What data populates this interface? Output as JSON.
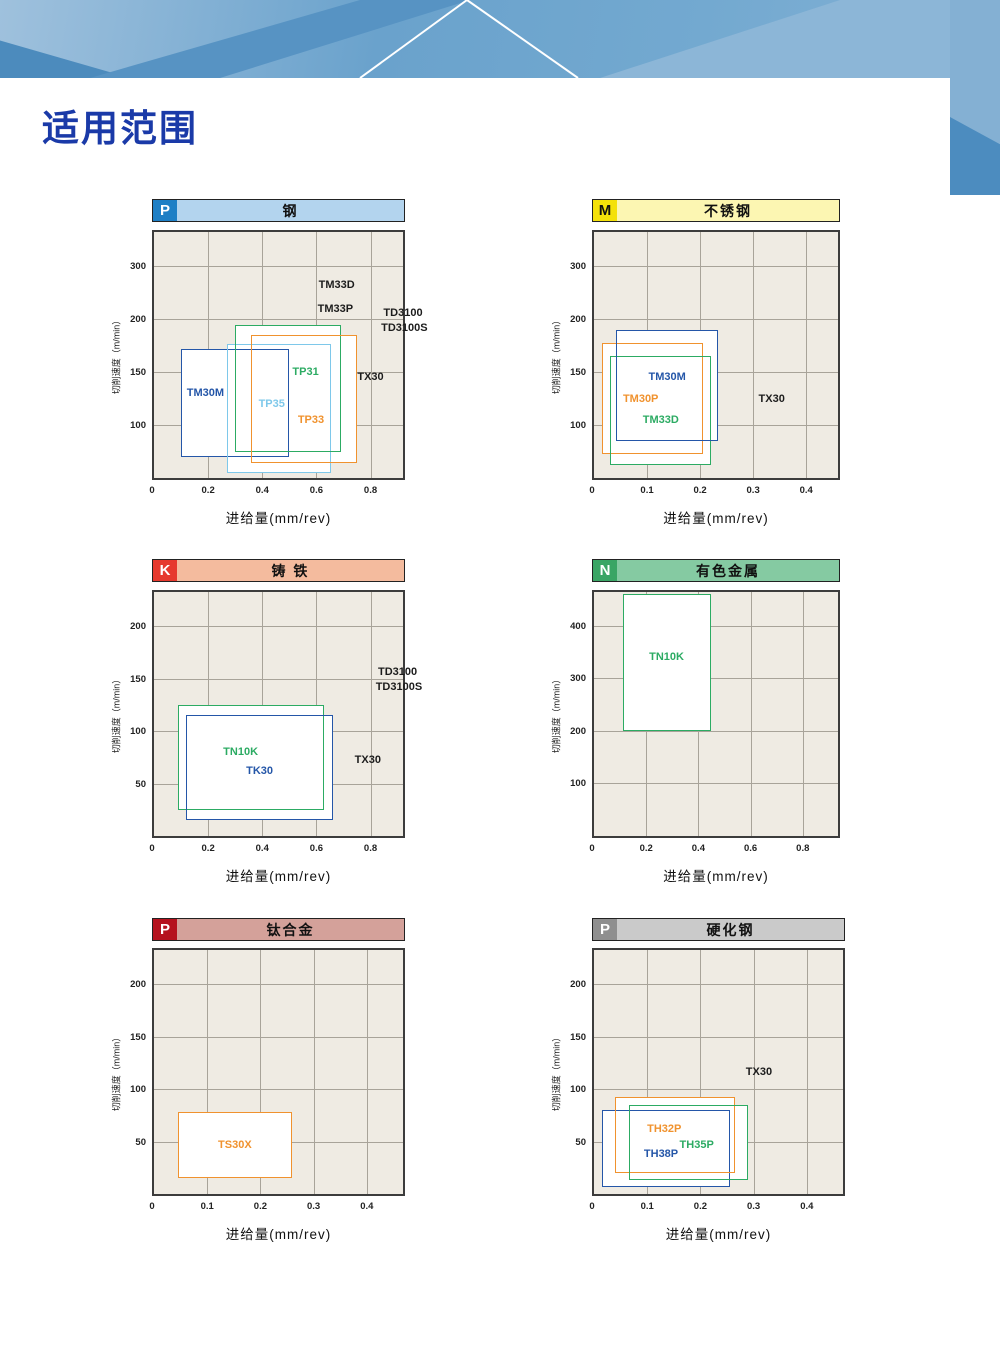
{
  "page": {
    "title": "适用范围",
    "accent": "#1a3aa8",
    "banner_colors": {
      "base": "#6aa2cc",
      "dark": "#5793c3",
      "light": "#8cb6d7",
      "line": "#ffffff"
    }
  },
  "chart_data": {
    "type": "range_boxes",
    "note": "Application range charts: cutting speed vs feed; boxes give usable range per grade",
    "charts": [
      {
        "id": "steel",
        "iso_class": "P",
        "title": "钢",
        "badge_bg": "#1e7fc5",
        "badge_fg": "#ffffff",
        "bar_bg": "#b3d4ee",
        "bar_fg": "#111111",
        "layout": {
          "x": 152,
          "header_y": 199,
          "plot_y": 230,
          "w": 253,
          "h": 250
        },
        "xlabel": "进给量(mm/rev)",
        "ylabel": "切削速度（m/min）",
        "origin_label": "0",
        "x_ticks": [
          0.2,
          0.4,
          0.6,
          0.8
        ],
        "x_max": 0.92,
        "y_ticks": [
          100,
          150,
          200,
          300
        ],
        "y_top_pad": 0.65,
        "series": [
          {
            "name": "TM30M",
            "color": "#2456a8",
            "x": [
              0.1,
              0.5
            ],
            "y": [
              40,
              172
            ]
          },
          {
            "name": "TP35",
            "color": "#7ec8ea",
            "x": [
              0.27,
              0.655
            ],
            "y": [
              10,
              177
            ]
          },
          {
            "name": "TP31",
            "color": "#2cab63",
            "x": [
              0.3,
              0.69
            ],
            "y": [
              50,
              195
            ]
          },
          {
            "name": "TP33",
            "color": "#f0922e",
            "x": [
              0.36,
              0.75
            ],
            "y": [
              28,
              185
            ]
          }
        ],
        "labels": [
          {
            "text": "TM30M",
            "x": 0.19,
            "y": 130,
            "color": "#2456a8"
          },
          {
            "text": "TP35",
            "x": 0.435,
            "y": 120,
            "color": "#7ec8ea"
          },
          {
            "text": "TP31",
            "x": 0.56,
            "y": 150,
            "color": "#2cab63"
          },
          {
            "text": "TP33",
            "x": 0.58,
            "y": 105,
            "color": "#f0922e"
          },
          {
            "text": "TX30",
            "x": 0.8,
            "y": 145,
            "color": "#1c1c1c"
          },
          {
            "text": "TM33D",
            "x": 0.675,
            "y": 265,
            "color": "#1c1c1c"
          },
          {
            "text": "TM33P",
            "x": 0.67,
            "y": 220,
            "color": "#1c1c1c"
          },
          {
            "text": "TD3100",
            "x": 0.92,
            "y": 212,
            "color": "#1c1c1c"
          },
          {
            "text": "TD3100S",
            "x": 0.925,
            "y": 192,
            "color": "#1c1c1c"
          }
        ]
      },
      {
        "id": "stainless-steel",
        "iso_class": "M",
        "title": "不锈钢",
        "badge_bg": "#f4e10a",
        "badge_fg": "#111111",
        "bar_bg": "#fcf6b2",
        "bar_fg": "#111111",
        "layout": {
          "x": 592,
          "header_y": 199,
          "plot_y": 230,
          "w": 248,
          "h": 250
        },
        "xlabel": "进给量(mm/rev)",
        "ylabel": "切削速度（m/min）",
        "origin_label": "0",
        "x_ticks": [
          0.1,
          0.2,
          0.3,
          0.4
        ],
        "x_max": 0.46,
        "y_ticks": [
          100,
          150,
          200,
          300
        ],
        "y_top_pad": 0.65,
        "series": [
          {
            "name": "TM30P",
            "color": "#f0922e",
            "x": [
              0.015,
              0.205
            ],
            "y": [
              45,
              178
            ]
          },
          {
            "name": "TM33D",
            "color": "#2cab63",
            "x": [
              0.03,
              0.22
            ],
            "y": [
              25,
              165
            ]
          },
          {
            "name": "TM30M",
            "color": "#2456a8",
            "x": [
              0.042,
              0.233
            ],
            "y": [
              70,
              190
            ]
          }
        ],
        "labels": [
          {
            "text": "TM30M",
            "x": 0.138,
            "y": 145,
            "color": "#2456a8"
          },
          {
            "text": "TM30P",
            "x": 0.088,
            "y": 125,
            "color": "#f0922e"
          },
          {
            "text": "TM33D",
            "x": 0.126,
            "y": 105,
            "color": "#2cab63"
          },
          {
            "text": "TX30",
            "x": 0.335,
            "y": 125,
            "color": "#1c1c1c"
          }
        ]
      },
      {
        "id": "cast-iron",
        "iso_class": "K",
        "title": "铸 铁",
        "badge_bg": "#e6392e",
        "badge_fg": "#ffffff",
        "bar_bg": "#f4bb9e",
        "bar_fg": "#111111",
        "layout": {
          "x": 152,
          "header_y": 559,
          "plot_y": 590,
          "w": 253,
          "h": 248
        },
        "xlabel": "进给量(mm/rev)",
        "ylabel": "切削速度（m/min）",
        "origin_label": "0",
        "x_ticks": [
          0.2,
          0.4,
          0.6,
          0.8
        ],
        "x_max": 0.92,
        "y_ticks": [
          50,
          100,
          150,
          200
        ],
        "y_top_pad": 0.65,
        "series": [
          {
            "name": "TN10K",
            "color": "#2cab63",
            "x": [
              0.09,
              0.63
            ],
            "y": [
              25,
              125
            ]
          },
          {
            "name": "TK30",
            "color": "#2456a8",
            "x": [
              0.12,
              0.66
            ],
            "y": [
              15,
              115
            ]
          }
        ],
        "labels": [
          {
            "text": "TN10K",
            "x": 0.32,
            "y": 80,
            "color": "#2cab63"
          },
          {
            "text": "TK30",
            "x": 0.39,
            "y": 62,
            "color": "#2456a8"
          },
          {
            "text": "TX30",
            "x": 0.79,
            "y": 72,
            "color": "#1c1c1c"
          },
          {
            "text": "TD3100",
            "x": 0.9,
            "y": 156,
            "color": "#1c1c1c"
          },
          {
            "text": "TD3100S",
            "x": 0.905,
            "y": 142,
            "color": "#1c1c1c"
          }
        ]
      },
      {
        "id": "non-ferrous-metal",
        "iso_class": "N",
        "title": "有色金属",
        "badge_bg": "#3aa565",
        "badge_fg": "#ffffff",
        "bar_bg": "#85caa2",
        "bar_fg": "#111111",
        "layout": {
          "x": 592,
          "header_y": 559,
          "plot_y": 590,
          "w": 248,
          "h": 248
        },
        "xlabel": "进给量(mm/rev)",
        "ylabel": "切削速度（m/min）",
        "origin_label": "0",
        "x_ticks": [
          0.2,
          0.4,
          0.6,
          0.8
        ],
        "x_max": 0.935,
        "y_ticks": [
          100,
          200,
          300,
          400
        ],
        "y_top_pad": 0.64,
        "series": [
          {
            "name": "TN10K",
            "color": "#2cab63",
            "x": [
              0.11,
              0.45
            ],
            "y": [
              200,
              460
            ]
          }
        ],
        "labels": [
          {
            "text": "TN10K",
            "x": 0.278,
            "y": 340,
            "color": "#2cab63"
          }
        ]
      },
      {
        "id": "titanium-alloy",
        "iso_class": "P",
        "title": "钛合金",
        "badge_bg": "#b5121e",
        "badge_fg": "#ffffff",
        "bar_bg": "#d4a19a",
        "bar_fg": "#111111",
        "layout": {
          "x": 152,
          "header_y": 918,
          "plot_y": 948,
          "w": 253,
          "h": 248
        },
        "xlabel": "进给量(mm/rev)",
        "ylabel": "切削速度（m/min）",
        "origin_label": "0",
        "x_ticks": [
          0.1,
          0.2,
          0.3,
          0.4
        ],
        "x_max": 0.468,
        "y_ticks": [
          50,
          100,
          150,
          200
        ],
        "y_top_pad": 0.65,
        "series": [
          {
            "name": "TS30X",
            "color": "#f0922e",
            "x": [
              0.045,
              0.26
            ],
            "y": [
              15,
              78
            ]
          }
        ],
        "labels": [
          {
            "text": "TS30X",
            "x": 0.152,
            "y": 47,
            "color": "#f0922e"
          }
        ]
      },
      {
        "id": "hardened-steel",
        "iso_class": "P",
        "title": "硬化钢",
        "badge_bg": "#8f8f8f",
        "badge_fg": "#ffffff",
        "bar_bg": "#cacaca",
        "bar_fg": "#111111",
        "layout": {
          "x": 592,
          "header_y": 918,
          "plot_y": 948,
          "w": 253,
          "h": 248
        },
        "xlabel": "进给量(mm/rev)",
        "ylabel": "切削速度（m/min）",
        "origin_label": "0",
        "x_ticks": [
          0.1,
          0.2,
          0.3,
          0.4
        ],
        "x_max": 0.468,
        "y_ticks": [
          50,
          100,
          150,
          200
        ],
        "y_top_pad": 0.65,
        "series": [
          {
            "name": "TH38P",
            "color": "#2456a8",
            "x": [
              0.015,
              0.255
            ],
            "y": [
              7,
              80
            ]
          },
          {
            "name": "TH32P",
            "color": "#f0922e",
            "x": [
              0.04,
              0.265
            ],
            "y": [
              20,
              92
            ]
          },
          {
            "name": "TH35P",
            "color": "#2cab63",
            "x": [
              0.065,
              0.29
            ],
            "y": [
              13,
              85
            ]
          }
        ],
        "labels": [
          {
            "text": "TH32P",
            "x": 0.132,
            "y": 62,
            "color": "#f0922e"
          },
          {
            "text": "TH35P",
            "x": 0.193,
            "y": 47,
            "color": "#2cab63"
          },
          {
            "text": "TH38P",
            "x": 0.126,
            "y": 38,
            "color": "#2456a8"
          },
          {
            "text": "TX30",
            "x": 0.31,
            "y": 116,
            "color": "#1c1c1c"
          }
        ]
      }
    ]
  }
}
